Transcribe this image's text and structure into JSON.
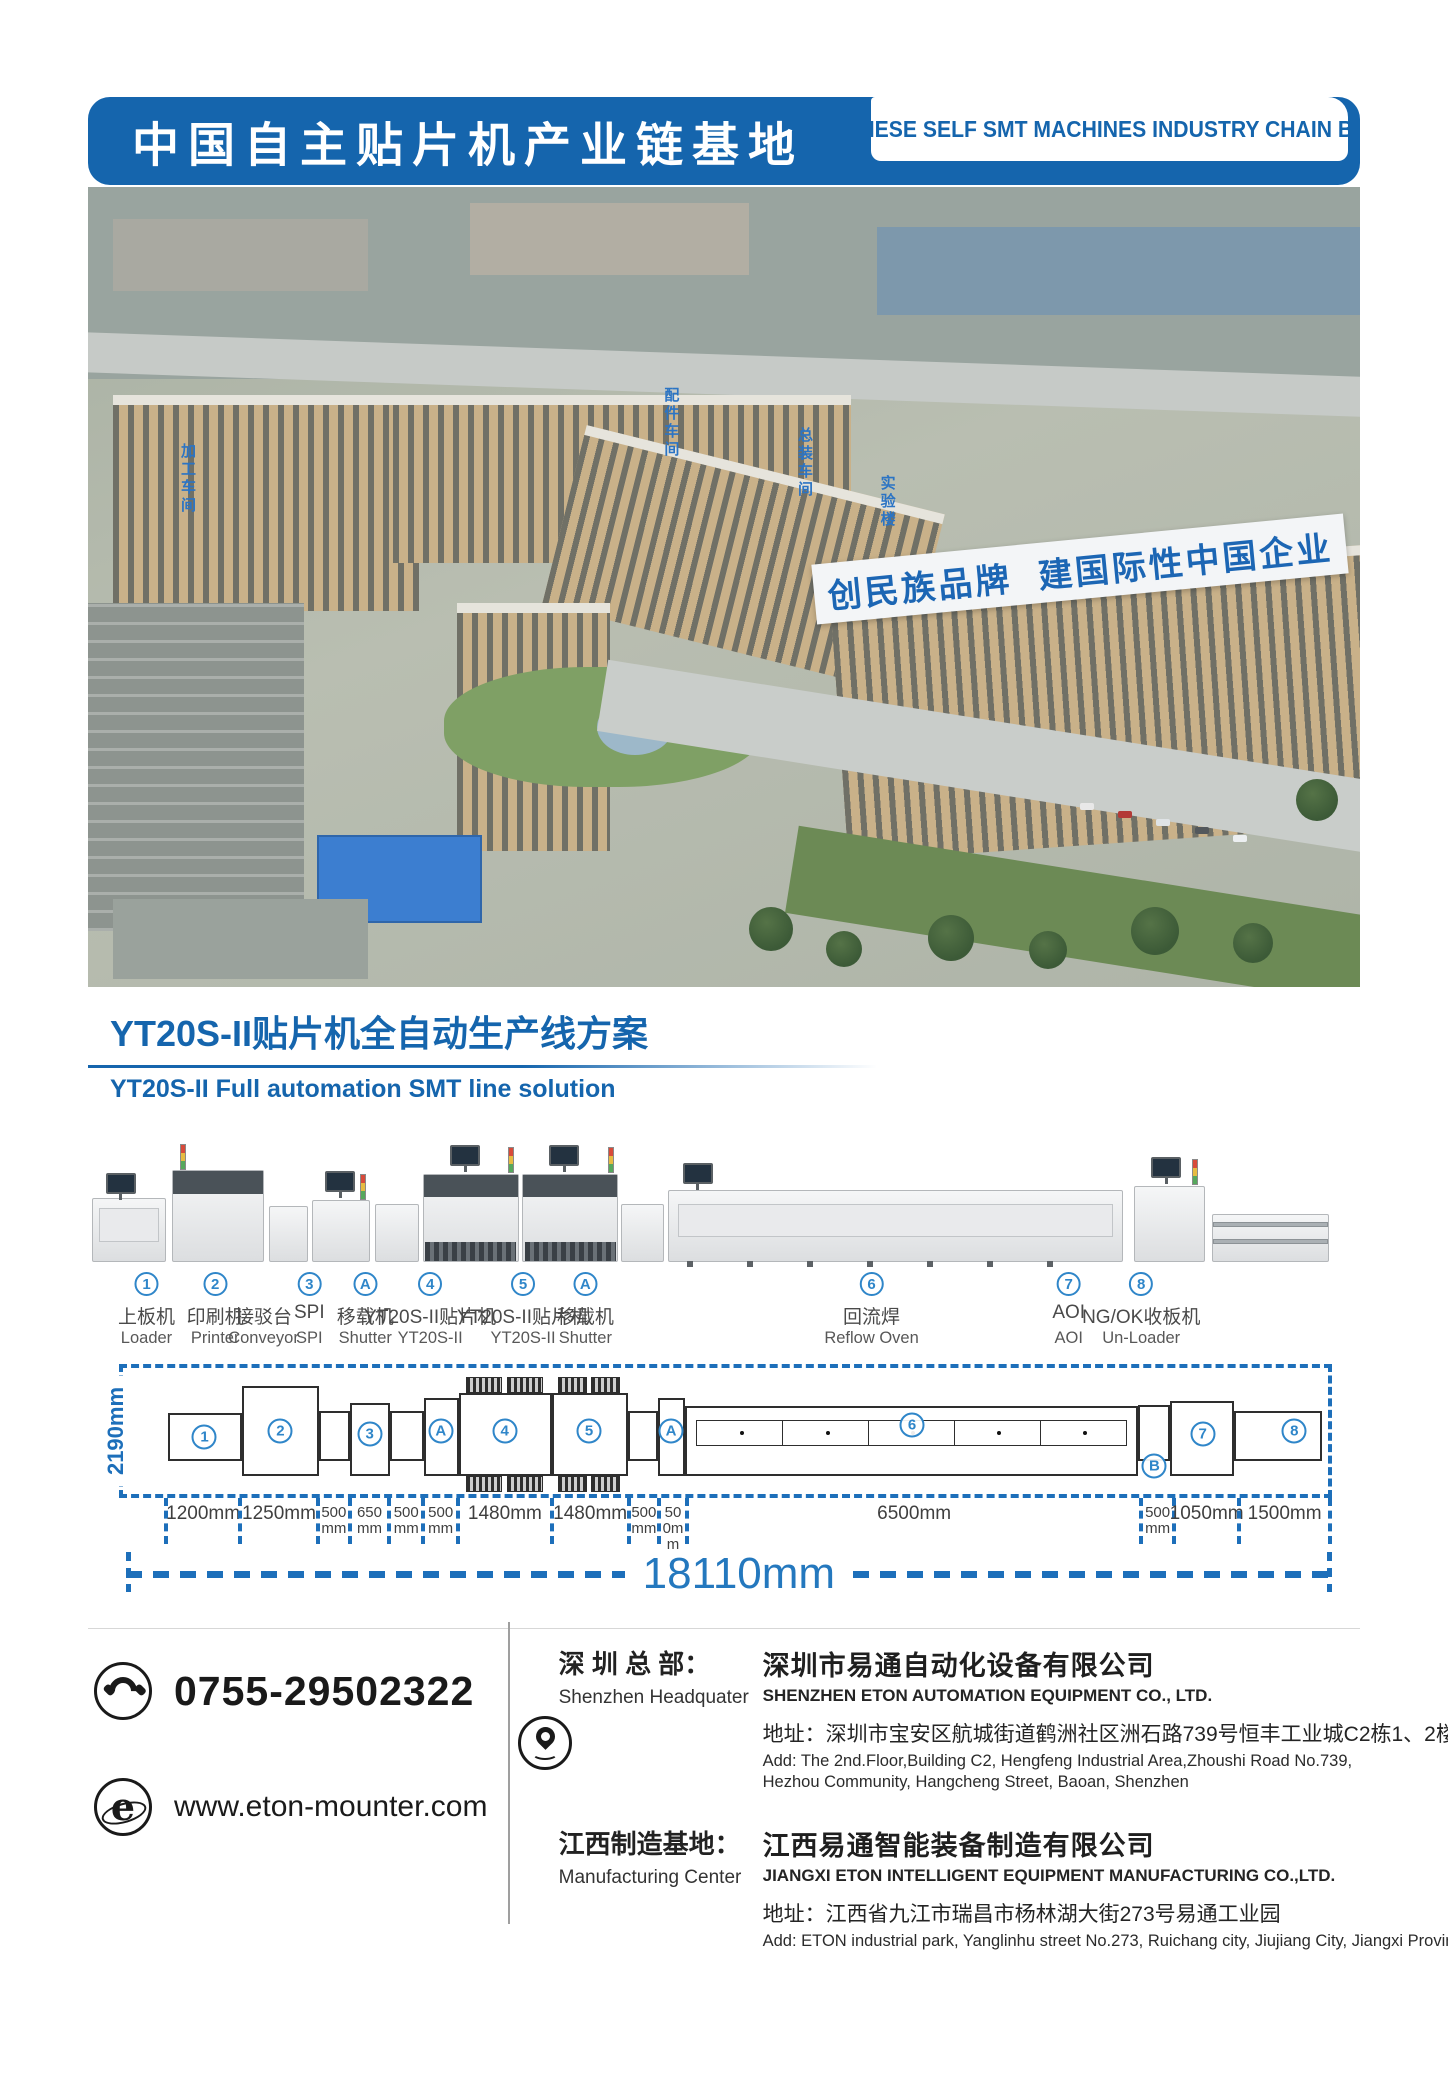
{
  "header": {
    "title_zh": "中国自主贴片机产业链基地",
    "title_en": "CHINESE SELF SMT MACHINES INDUSTRY CHAIN BASE"
  },
  "photo": {
    "slogan": "创民族品牌 建国际性中国企业",
    "signs": {
      "s1": "加工车间",
      "s2": "配件车间",
      "s3": "总装车间",
      "s4": "实验楼"
    }
  },
  "section": {
    "title_zh": "YT20S-II贴片机全自动生产线方案",
    "subtitle_en": "YT20S-II Full automation SMT line solution"
  },
  "line": {
    "machines": [
      {
        "num": "1",
        "zh": "上板机",
        "en": "Loader"
      },
      {
        "num": "2",
        "zh": "印刷机",
        "en": "Printer"
      },
      {
        "num": "",
        "zh": "接驳台",
        "en": "Conveyor"
      },
      {
        "num": "3",
        "zh": "SPI",
        "en": "SPI"
      },
      {
        "num": "A",
        "zh": "移载机",
        "en": "Shutter"
      },
      {
        "num": "4",
        "zh": "YT20S-II贴片机",
        "en": "YT20S-II"
      },
      {
        "num": "5",
        "zh": "YT20S-II贴片机",
        "en": "YT20S-II"
      },
      {
        "num": "A",
        "zh": "移载机",
        "en": "Shutter"
      },
      {
        "num": "6",
        "zh": "回流焊",
        "en": "Reflow Oven"
      },
      {
        "num": "7",
        "zh": "AOI",
        "en": "AOI"
      },
      {
        "num": "8",
        "zh": "NG/OK收板机",
        "en": "Un-Loader"
      }
    ]
  },
  "diagram": {
    "height_label": "2190mm",
    "total_label": "18110mm",
    "segments": [
      "1200mm",
      "1250mm",
      "500mm",
      "650mm",
      "500mm",
      "500mm",
      "1480mm",
      "1480mm",
      "500mm",
      "500mm",
      "6500mm",
      "500mm",
      "1050mm",
      "1500mm"
    ],
    "callouts": {
      "c1": "1",
      "c2": "2",
      "c3": "3",
      "cA1": "A",
      "c4": "4",
      "c5": "5",
      "cA2": "A",
      "c6": "6",
      "cB": "B",
      "c7": "7",
      "c8": "8"
    }
  },
  "footer": {
    "phone": "0755-29502322",
    "website": "www.eton-mounter.com",
    "icons": {
      "website_glyph": "e"
    },
    "hq": {
      "label_zh": "深 圳 总 部：",
      "label_en": "Shenzhen Headquater",
      "company_zh": "深圳市易通自动化设备有限公司",
      "company_en": "SHENZHEN ETON AUTOMATION EQUIPMENT CO., LTD.",
      "addr_zh": "地址：深圳市宝安区航城街道鹤洲社区洲石路739号恒丰工业城C2栋1、2楼",
      "addr_en": "Add: The 2nd.Floor,Building C2, Hengfeng Industrial Area,Zhoushi Road No.739, Hezhou Community, Hangcheng Street, Baoan, Shenzhen"
    },
    "mfg": {
      "label_zh": "江西制造基地：",
      "label_en": "Manufacturing Center",
      "company_zh": "江西易通智能装备制造有限公司",
      "company_en": "JIANGXI ETON INTELLIGENT EQUIPMENT MANUFACTURING CO.,LTD.",
      "addr_zh": "地址：江西省九江市瑞昌市杨林湖大街273号易通工业园",
      "addr_en": "Add: ETON industrial park, Yanglinhu street No.273, Ruichang city, Jiujiang City, Jiangxi Province"
    }
  },
  "colors": {
    "brand_blue": "#1565ad",
    "accent_blue": "#2f86c9",
    "dash_blue": "#1d6fba",
    "text_dark": "#3f3f3f"
  }
}
